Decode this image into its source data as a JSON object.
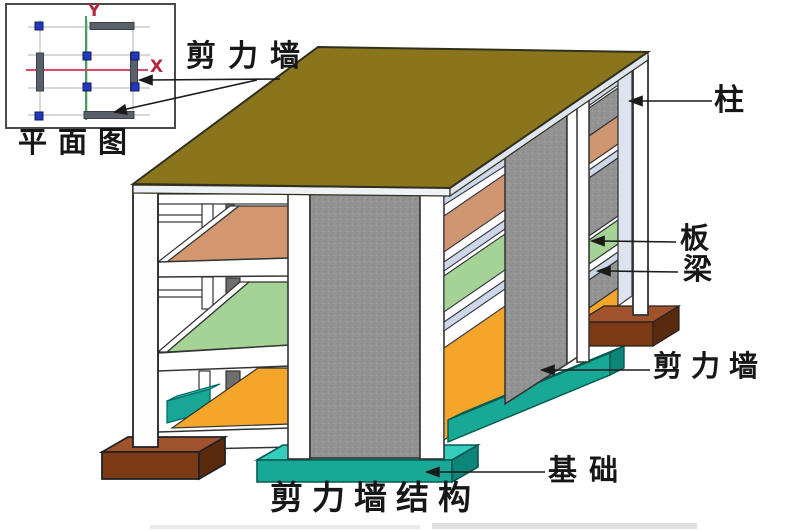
{
  "plan_view": {
    "caption": "平面图",
    "axis_y_label": "Y",
    "axis_x_label": "X"
  },
  "annotations": {
    "shear_wall_plan": "剪力墙",
    "column": "柱",
    "slab": "板",
    "beam": "梁",
    "shear_wall_3d": "剪力墙",
    "foundation": "基础"
  },
  "caption": "剪力墙结构",
  "palette": {
    "roof_olive": "#8a741c",
    "slab_salmon": "#d2976f",
    "slab_green": "#a5d295",
    "slab_orange": "#f4a62a",
    "foundation_teal_top": "#35cdbb",
    "foundation_teal_front": "#17a896",
    "footing_brown_top": "#a0522d",
    "footing_brown_front": "#7b3a14",
    "shear_wall_gray": "#939393",
    "beam_blue": "#ccd7e8",
    "column_white": "#fefefe",
    "axis_x_red": "#d84a66",
    "axis_y_green": "#3aa45a",
    "plan_node_blue": "#2438b8",
    "plan_wall_gray": "#5a6069"
  }
}
